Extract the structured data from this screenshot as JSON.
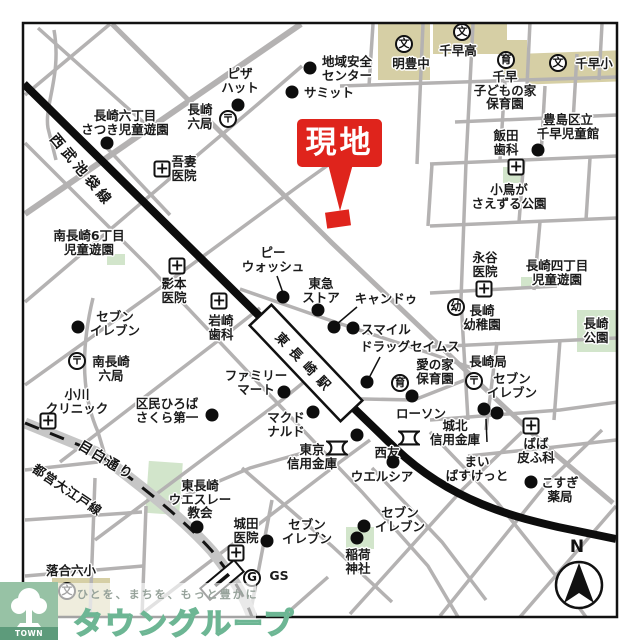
{
  "site": {
    "label": "現地",
    "color": "#df241c"
  },
  "compass": {
    "label": "N"
  },
  "roads": {
    "seibu_line": "西武池袋線",
    "station": "東長崎駅",
    "mejiro_dori": "目白通り",
    "oedo_line": "都営大江戸線"
  },
  "logo": {
    "group_name": "TOWN GROUP",
    "brand": "タウングループ",
    "tagline": "ひとを、まちを、もっと豊かに",
    "green": "#6db694"
  },
  "colors": {
    "street": "#b4b2b2",
    "railway": "#0d0d0d",
    "school_block": "#d6cfa5",
    "park_block": "#d2e5cb",
    "site_red": "#df241c"
  },
  "icons": {
    "post": "〒",
    "school": "文",
    "kindergarten": "幼",
    "nursery": "育",
    "hospital": "+",
    "gs": "G",
    "bank": "bank-symbol"
  },
  "landmarks": [
    {
      "id": "chiiki-anzen-center",
      "lines": [
        "地域安全",
        "センター"
      ],
      "x": 347,
      "y": 55,
      "dots": [
        [
          310,
          68
        ]
      ]
    },
    {
      "id": "summit",
      "lines": [
        "サミット"
      ],
      "x": 329,
      "y": 86,
      "dots": [
        [
          292,
          92
        ]
      ]
    },
    {
      "id": "pizza-hut",
      "lines": [
        "ピザ",
        "ハット"
      ],
      "x": 240,
      "y": 67,
      "dots": [
        [
          238,
          105
        ]
      ]
    },
    {
      "id": "meiho-junior-high",
      "lines": [
        "明豊中"
      ],
      "x": 411,
      "y": 57,
      "icon": {
        "type": "school",
        "x": 404,
        "y": 44
      }
    },
    {
      "id": "chihaya-high",
      "lines": [
        "千早高"
      ],
      "x": 458,
      "y": 44,
      "icon": {
        "type": "school",
        "x": 462,
        "y": 32
      }
    },
    {
      "id": "chihaya-kodomo-hoikuen",
      "lines": [
        "千早",
        "子どもの家",
        "保育園"
      ],
      "x": 505,
      "y": 70,
      "icon": {
        "type": "nursery",
        "x": 506,
        "y": 60
      }
    },
    {
      "id": "chihaya-elementary",
      "lines": [
        "千早小"
      ],
      "x": 594,
      "y": 57,
      "icon": {
        "type": "school",
        "x": 558,
        "y": 63
      }
    },
    {
      "id": "toshima-chihaya-jidokan",
      "lines": [
        "豊島区立",
        "千早児童館"
      ],
      "x": 568,
      "y": 113,
      "dots": [
        [
          538,
          150
        ]
      ]
    },
    {
      "id": "iida-dental",
      "lines": [
        "飯田",
        "歯科"
      ],
      "x": 506,
      "y": 129,
      "icon": {
        "type": "hospital",
        "x": 516,
        "y": 167
      }
    },
    {
      "id": "kotori-park",
      "lines": [
        "小鳥が",
        "さえずる公園"
      ],
      "x": 509,
      "y": 183
    },
    {
      "id": "nagasaki6-satsuki-park",
      "lines": [
        "長崎六丁目",
        "さつき児童遊園"
      ],
      "x": 125,
      "y": 109,
      "dots": [
        [
          107,
          143
        ]
      ]
    },
    {
      "id": "nagasaki-6-post",
      "lines": [
        "長崎",
        "六局"
      ],
      "x": 200,
      "y": 103,
      "icon": {
        "type": "post",
        "x": 228,
        "y": 119
      }
    },
    {
      "id": "azuma-clinic",
      "lines": [
        "吾妻",
        "医院"
      ],
      "x": 184,
      "y": 155,
      "icon": {
        "type": "hospital",
        "x": 162,
        "y": 169
      }
    },
    {
      "id": "minami-nagasaki6-park",
      "lines": [
        "南長崎6丁目",
        "児童遊園"
      ],
      "x": 89,
      "y": 229
    },
    {
      "id": "kagemoto-clinic",
      "lines": [
        "影本",
        "医院"
      ],
      "x": 174,
      "y": 277,
      "icon": {
        "type": "hospital",
        "x": 177,
        "y": 266
      }
    },
    {
      "id": "iwasaki-dental",
      "lines": [
        "岩崎",
        "歯科"
      ],
      "x": 221,
      "y": 314,
      "icon": {
        "type": "hospital",
        "x": 219,
        "y": 301
      }
    },
    {
      "id": "seven-eleven-west",
      "lines": [
        "セブン",
        "イレブン"
      ],
      "x": 115,
      "y": 310,
      "dots": [
        [
          78,
          327
        ]
      ]
    },
    {
      "id": "minami-nagasaki-6-post",
      "lines": [
        "南長崎",
        "六局"
      ],
      "x": 111,
      "y": 355,
      "icon": {
        "type": "post",
        "x": 77,
        "y": 361
      }
    },
    {
      "id": "ogawa-clinic",
      "lines": [
        "小川",
        "クリニック"
      ],
      "x": 77,
      "y": 388,
      "icon": {
        "type": "hospital",
        "x": 48,
        "y": 421
      }
    },
    {
      "id": "kumin-hiroba-sakura",
      "lines": [
        "区民ひろば",
        "さくら第一"
      ],
      "x": 167,
      "y": 397,
      "dots": [
        [
          212,
          415
        ]
      ]
    },
    {
      "id": "pea-wash",
      "lines": [
        "ピー",
        "ウォッシュ"
      ],
      "x": 273,
      "y": 246,
      "dots": [
        [
          283,
          297
        ]
      ]
    },
    {
      "id": "tokyu-store",
      "lines": [
        "東急",
        "ストア"
      ],
      "x": 321,
      "y": 277,
      "dots": [
        [
          318,
          310
        ]
      ]
    },
    {
      "id": "cando",
      "lines": [
        "キャンドゥ"
      ],
      "x": 386,
      "y": 292,
      "dots": [
        [
          334,
          327
        ]
      ]
    },
    {
      "id": "smile",
      "lines": [
        "スマイル"
      ],
      "x": 386,
      "y": 323,
      "dots": [
        [
          353,
          328
        ]
      ]
    },
    {
      "id": "drug-seims",
      "lines": [
        "ドラッグセイムス"
      ],
      "x": 410,
      "y": 340,
      "dots": [
        [
          367,
          382
        ]
      ]
    },
    {
      "id": "family-mart",
      "lines": [
        "ファミリー",
        "マート"
      ],
      "x": 256,
      "y": 369,
      "dots": [
        [
          284,
          392
        ]
      ]
    },
    {
      "id": "mcdonalds",
      "lines": [
        "マクド",
        "ナルド"
      ],
      "x": 286,
      "y": 411,
      "dots": [
        [
          313,
          412
        ]
      ]
    },
    {
      "id": "lawson",
      "lines": [
        "ローソン"
      ],
      "x": 421,
      "y": 407,
      "dots": [
        [
          412,
          396
        ]
      ]
    },
    {
      "id": "ai-no-ie-hoikuen",
      "lines": [
        "愛の家",
        "保育園"
      ],
      "x": 435,
      "y": 358,
      "icon": {
        "type": "nursery",
        "x": 400,
        "y": 383
      }
    },
    {
      "id": "tokyo-shinkin-bank",
      "lines": [
        "東京",
        "信用金庫"
      ],
      "x": 312,
      "y": 443,
      "icon": {
        "type": "bank",
        "x": 337,
        "y": 448
      }
    },
    {
      "id": "seiyu",
      "lines": [
        "西友"
      ],
      "x": 387,
      "y": 446,
      "dots": [
        [
          357,
          435
        ]
      ]
    },
    {
      "id": "welcia",
      "lines": [
        "ウエルシア"
      ],
      "x": 382,
      "y": 470,
      "dots": [
        [
          393,
          462
        ]
      ]
    },
    {
      "id": "johoku-shinkin-bank",
      "lines": [
        "城北",
        "信用金庫"
      ],
      "x": 455,
      "y": 419,
      "icon": {
        "type": "bank",
        "x": 409,
        "y": 438
      }
    },
    {
      "id": "my-basket",
      "lines": [
        "まい",
        "ばすけっと"
      ],
      "x": 477,
      "y": 455
    },
    {
      "id": "seven-eleven-east",
      "lines": [
        "セブン",
        "イレブン"
      ],
      "x": 512,
      "y": 372,
      "dots": [
        [
          484,
          409
        ],
        [
          497,
          413
        ]
      ]
    },
    {
      "id": "baba-hifuka",
      "lines": [
        "ばば",
        "皮ふ科"
      ],
      "x": 536,
      "y": 437,
      "icon": {
        "type": "hospital",
        "x": 531,
        "y": 426
      }
    },
    {
      "id": "kosugi-pharmacy",
      "lines": [
        "こすぎ",
        "薬局"
      ],
      "x": 560,
      "y": 476,
      "dots": [
        [
          531,
          482
        ]
      ]
    },
    {
      "id": "seven-eleven-center",
      "lines": [
        "セブン",
        "イレブン"
      ],
      "x": 400,
      "y": 506,
      "dots": [
        [
          364,
          526
        ]
      ]
    },
    {
      "id": "inari-shrine",
      "lines": [
        "稲荷",
        "神社"
      ],
      "x": 358,
      "y": 548,
      "dots": [
        [
          357,
          538
        ]
      ]
    },
    {
      "id": "seven-eleven-south",
      "lines": [
        "セブン",
        "イレブン"
      ],
      "x": 307,
      "y": 518,
      "dots": [
        [
          267,
          541
        ]
      ]
    },
    {
      "id": "shirota-clinic",
      "lines": [
        "城田",
        "医院"
      ],
      "x": 246,
      "y": 517,
      "icon": {
        "type": "hospital",
        "x": 236,
        "y": 553
      }
    },
    {
      "id": "gs-station",
      "lines": [
        "GS"
      ],
      "x": 279,
      "y": 569,
      "icon": {
        "type": "gs",
        "x": 252,
        "y": 578
      }
    },
    {
      "id": "wesley-church",
      "lines": [
        "東長崎",
        "ウエスレー",
        "教会"
      ],
      "x": 200,
      "y": 479,
      "dots": [
        [
          197,
          527
        ]
      ]
    },
    {
      "id": "ochiai-roku-elementary",
      "lines": [
        "落合六小"
      ],
      "x": 71,
      "y": 564,
      "icon": {
        "type": "school",
        "x": 67,
        "y": 591
      }
    },
    {
      "id": "nagaya-clinic",
      "lines": [
        "永谷",
        "医院"
      ],
      "x": 485,
      "y": 251,
      "icon": {
        "type": "hospital",
        "x": 484,
        "y": 289
      }
    },
    {
      "id": "nagasaki4-jido-park",
      "lines": [
        "長崎四丁目",
        "児童遊園"
      ],
      "x": 557,
      "y": 259
    },
    {
      "id": "nagasaki-kindergarten",
      "lines": [
        "長崎",
        "幼稚園"
      ],
      "x": 482,
      "y": 304,
      "icon": {
        "type": "kindergarten",
        "x": 456,
        "y": 307
      }
    },
    {
      "id": "nagasaki-park",
      "lines": [
        "長崎",
        "公園"
      ],
      "x": 596,
      "y": 317
    },
    {
      "id": "nagasaki-post",
      "lines": [
        "長崎局"
      ],
      "x": 488,
      "y": 355,
      "icon": {
        "type": "post",
        "x": 474,
        "y": 381
      }
    }
  ]
}
